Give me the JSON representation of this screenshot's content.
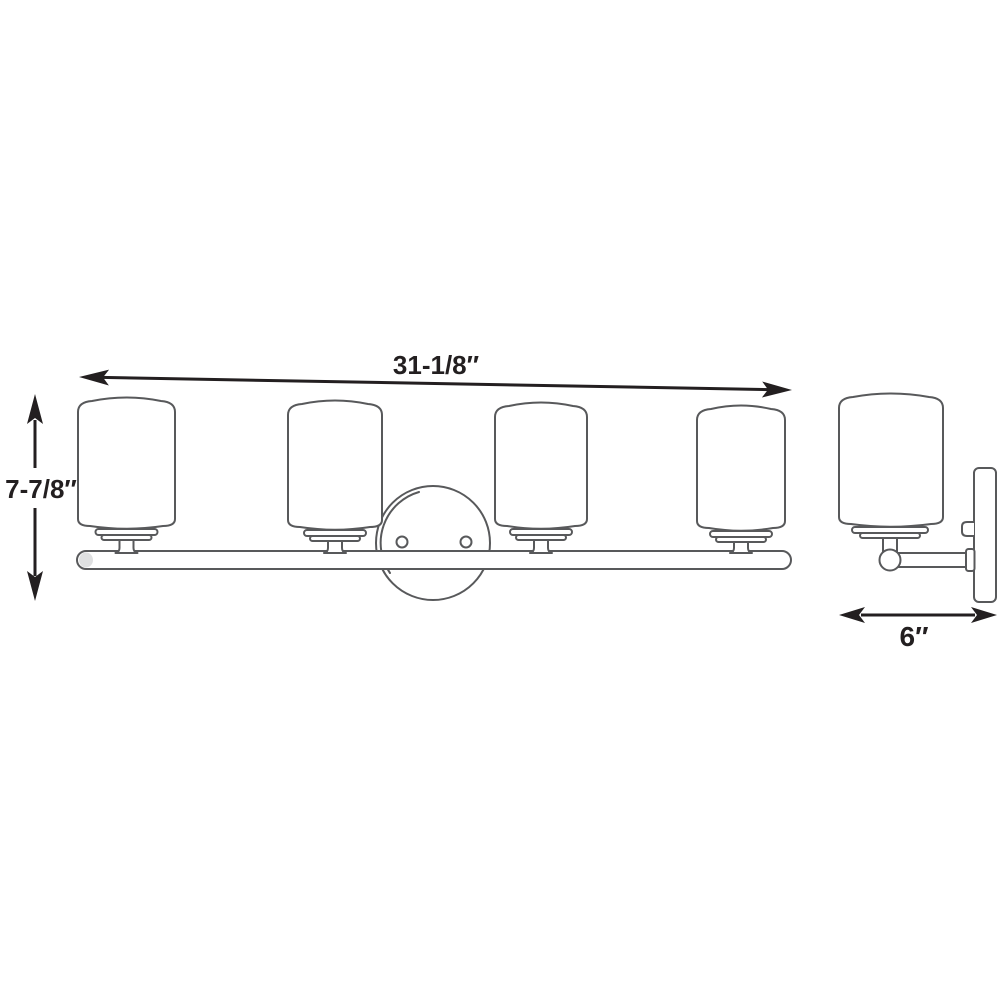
{
  "colors": {
    "background": "#ffffff",
    "line": "#58595b",
    "dimension": "#231f20"
  },
  "diagram": {
    "kind": "product dimension line drawing",
    "views": {
      "front": {
        "name": "front view",
        "light_count": 4
      },
      "side": {
        "name": "side view"
      }
    },
    "dimensions": {
      "width": {
        "label": "31-1/8″"
      },
      "height": {
        "label": "7-7/8″"
      },
      "depth": {
        "label": "6″"
      }
    }
  }
}
